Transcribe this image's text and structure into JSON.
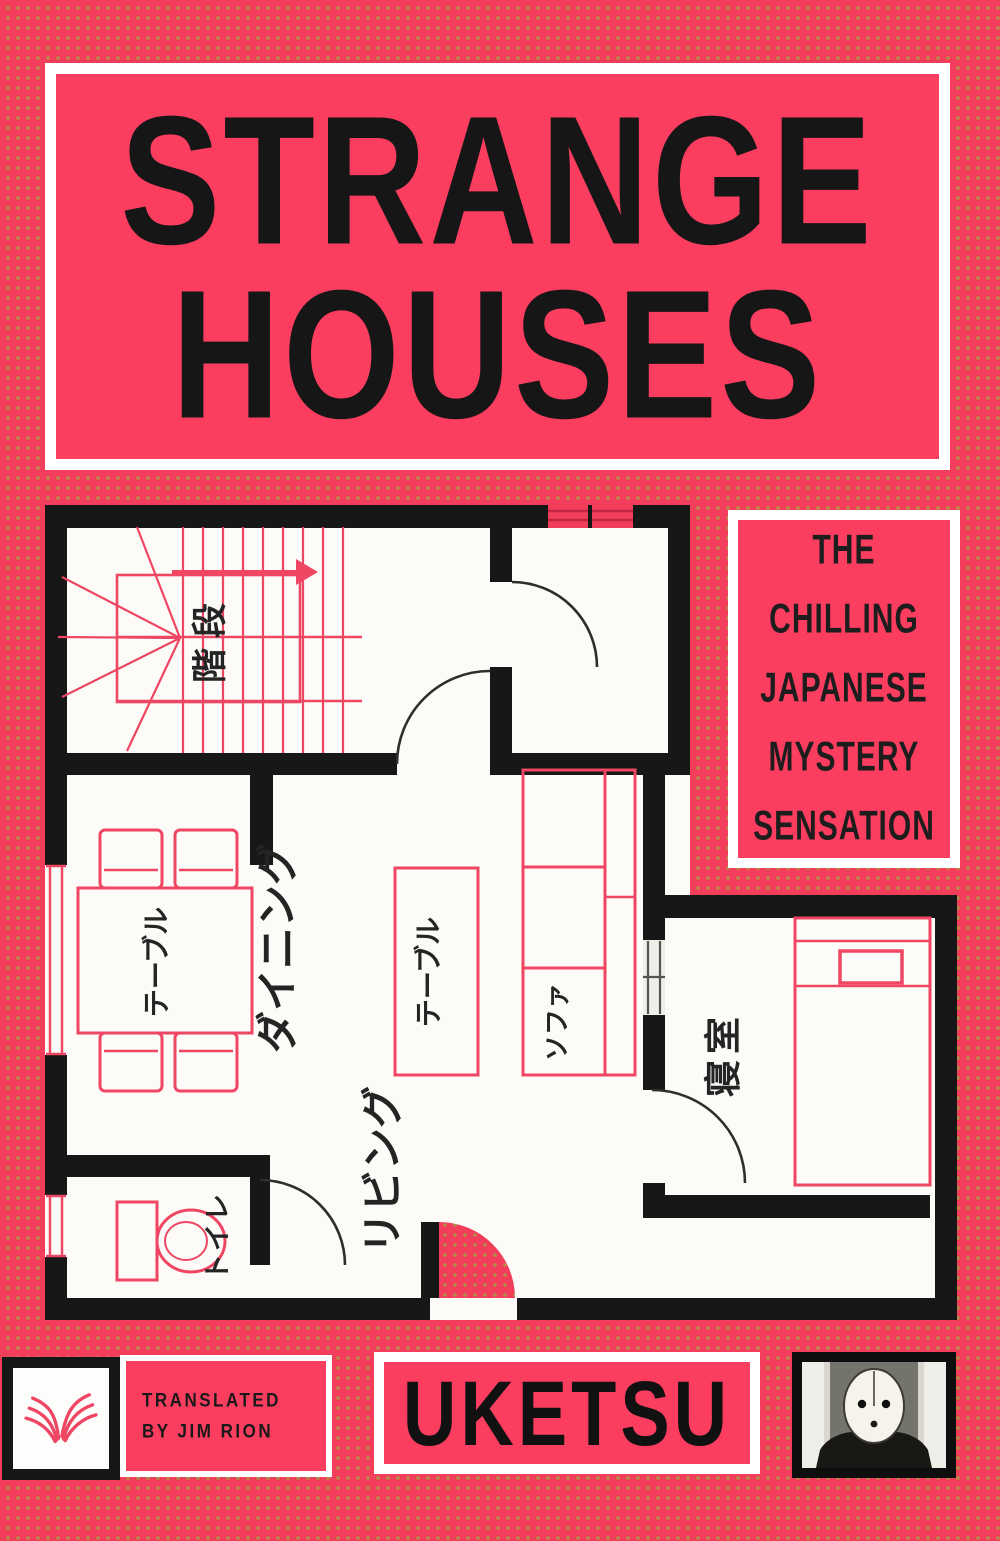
{
  "cover": {
    "title": {
      "line1": "STRANGE",
      "line2": "HOUSES"
    },
    "tagline": [
      "THE",
      "CHILLING",
      "JAPANESE",
      "MYSTERY",
      "SENSATION"
    ],
    "translator": {
      "line1": "TRANSLATED",
      "line2": "BY JIM RION"
    },
    "author": "UKETSU"
  },
  "floor_plan": {
    "labels": {
      "stairs": "階段",
      "dining": "ダイニング",
      "dining_table": "テーブル",
      "living": "リビング",
      "living_table": "テーブル",
      "sofa": "ソファ",
      "bedroom": "寝室",
      "toilet": "トイレ"
    }
  },
  "icons": {
    "publisher_logo": "open-book-logo",
    "author_photo": "masked-face-portrait"
  },
  "colors": {
    "background": "#f23e5b",
    "panel_pink": "#fb3d5f",
    "dot_olive": "#b09147",
    "ink": "#161616",
    "plan_pink": "#ee4663",
    "wall": "#171717",
    "floor": "#fcfbf7",
    "arc": "#2e2e2e"
  }
}
